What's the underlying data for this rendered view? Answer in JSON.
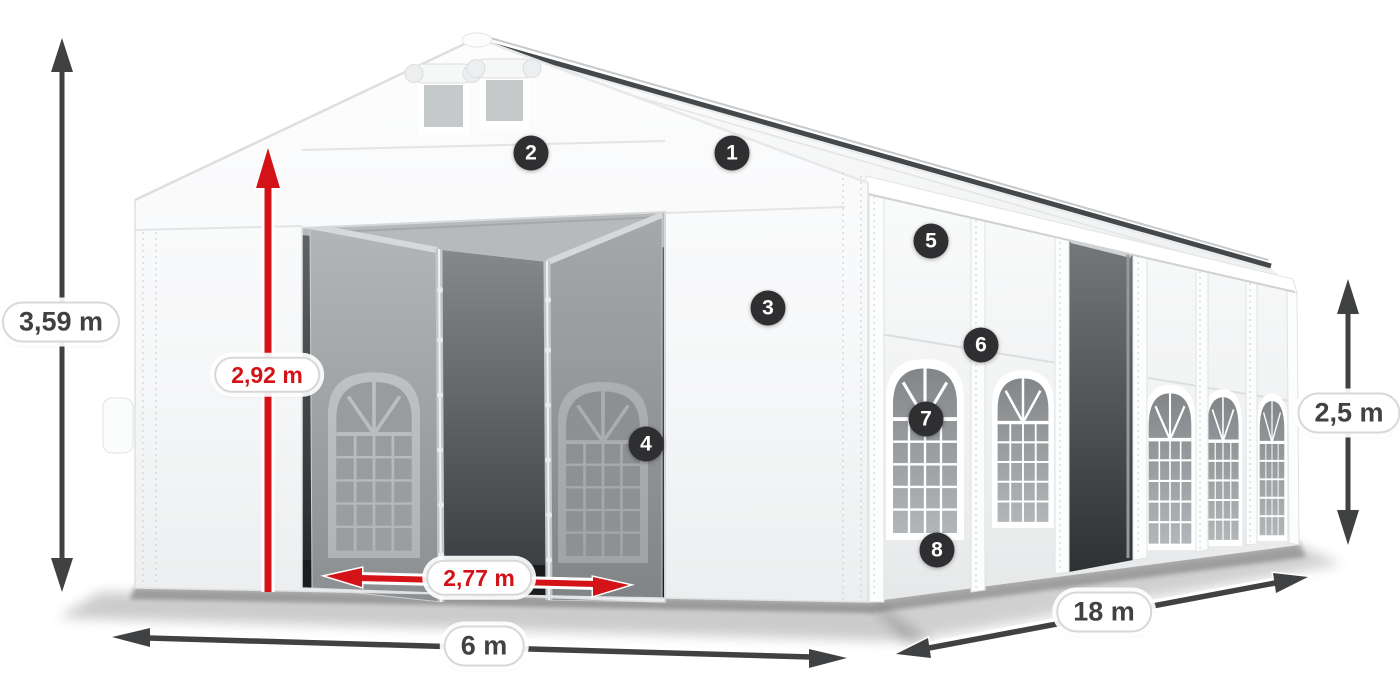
{
  "scene": {
    "background": "#ffffff",
    "subject": "white party tent 6x18 m with open front doors and side entrance"
  },
  "dimensions": [
    {
      "id": "total-height",
      "label": "3,59 m",
      "color": "gray"
    },
    {
      "id": "entrance-height",
      "label": "2,92 m",
      "color": "red"
    },
    {
      "id": "entrance-width",
      "label": "2,77 m",
      "color": "red"
    },
    {
      "id": "front-width",
      "label": "6 m",
      "color": "gray"
    },
    {
      "id": "side-length",
      "label": "18 m",
      "color": "gray"
    },
    {
      "id": "side-height",
      "label": "2,5 m",
      "color": "gray"
    }
  ],
  "callouts": [
    {
      "number": "1"
    },
    {
      "number": "2"
    },
    {
      "number": "3"
    },
    {
      "number": "4"
    },
    {
      "number": "5"
    },
    {
      "number": "6"
    },
    {
      "number": "7"
    },
    {
      "number": "8"
    }
  ],
  "colors": {
    "dimension_gray": "#3f4143",
    "dimension_red": "#d31317",
    "badge_background": "#2f2f31",
    "badge_text": "#ffffff",
    "pill_background": "#ffffff",
    "pill_border": "#d8d8d8"
  }
}
